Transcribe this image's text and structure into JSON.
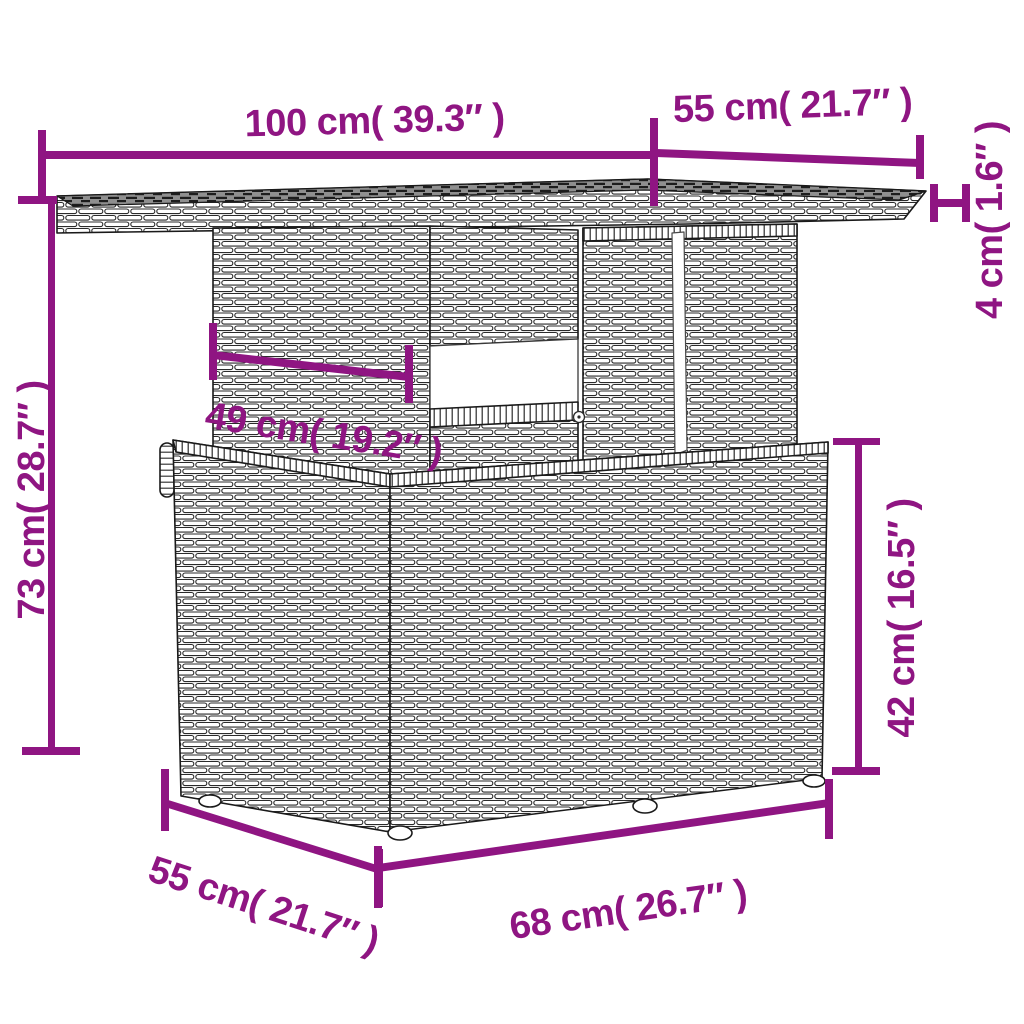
{
  "figure": {
    "type": "product-dimension-diagram",
    "subject": "poly rattan lift-top garden table line drawing",
    "accent_color": "#8F1582",
    "line_color": "#1a1a1a",
    "background": "#ffffff"
  },
  "dimensions": {
    "top_width": "100 cm( 39.3″ )",
    "top_depth": "55 cm( 21.7″ )",
    "top_thickness": "4 cm( 1.6″ )",
    "total_height": "73 cm( 28.7″ )",
    "inner_width": "49 cm( 19.2″ )",
    "base_height": "42 cm( 16.5″ )",
    "base_width": "68 cm( 26.7″ )",
    "base_depth": "55 cm( 21.7″ )"
  }
}
